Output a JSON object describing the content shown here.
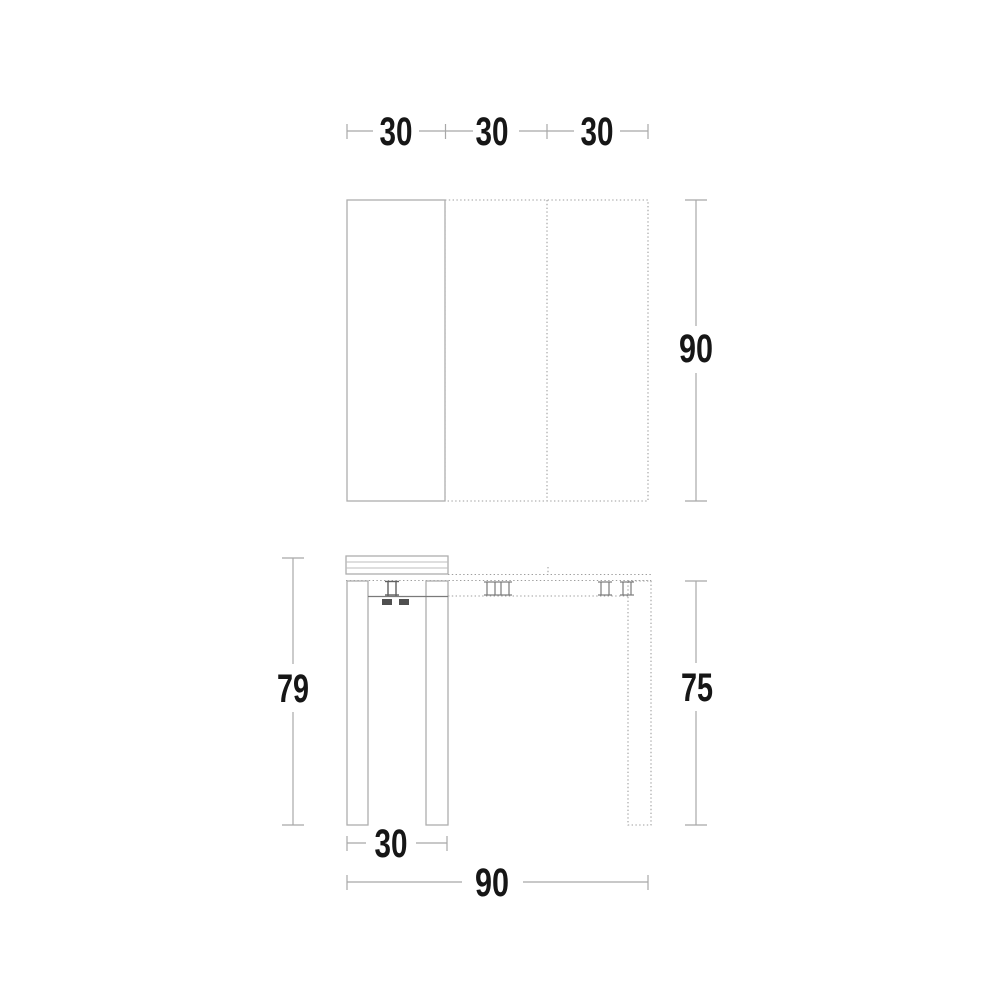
{
  "drawing": {
    "description": "Dimensioned technical line drawing of an extendable console table: top view with three equal leaves and depth dimension, front view with heights and widths",
    "colors": {
      "background": "#ffffff",
      "outline": "#aeaeae",
      "dotted_line": "#9e9e9e",
      "detail_dark": "#5f5f5f",
      "dimension_line": "#a8a8a8",
      "label_text": "#161616"
    },
    "top_view": {
      "leaf_width_dims": [
        "30",
        "30",
        "30"
      ],
      "depth_dim": "90"
    },
    "front_view": {
      "total_height_dim": "79",
      "leg_height_dim": "75",
      "closed_width_dim": "30",
      "extended_width_dim": "90"
    }
  }
}
